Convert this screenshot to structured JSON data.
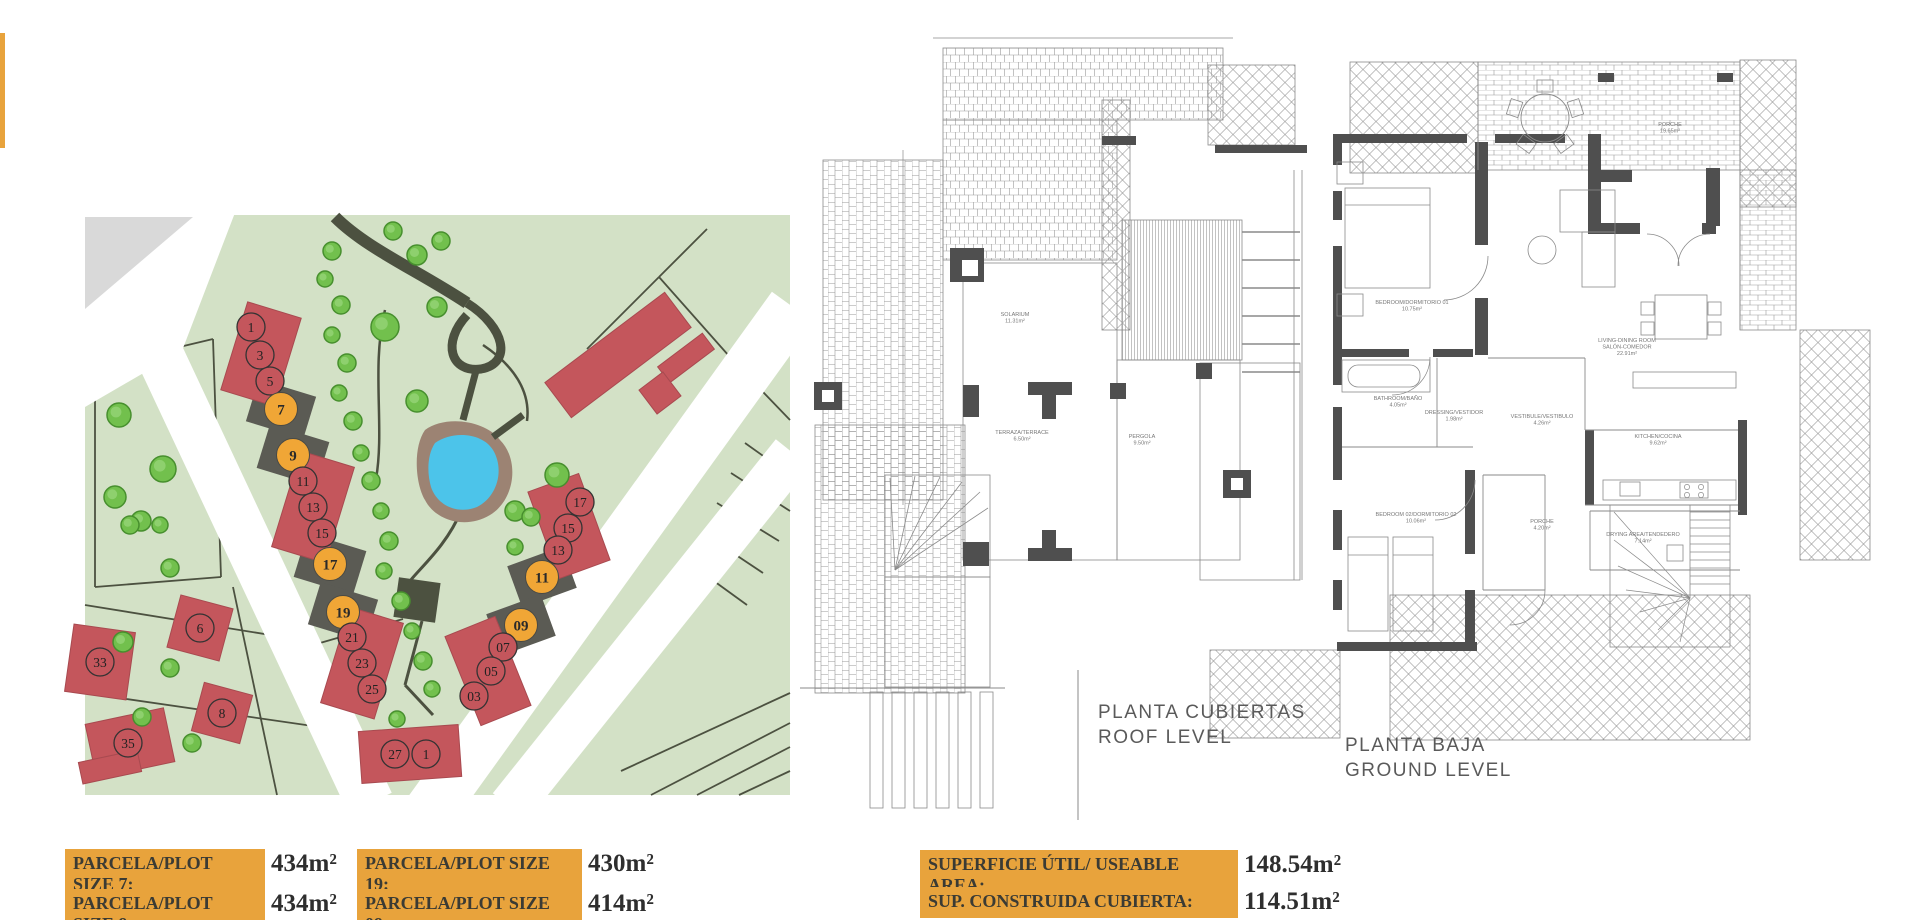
{
  "colors": {
    "accent_orange": "#E8A33C",
    "plot_red": "#C4565C",
    "plot_orange": "#F0A636",
    "map_green": "#D3E1C6",
    "pool_blue": "#4CC4EA",
    "path_olive": "#4C5140",
    "plan_line": "#8A8A8A",
    "wall_gray": "#4F4F4F"
  },
  "site_plan": {
    "markers": [
      {
        "n": "1",
        "x": 166,
        "y": 112,
        "c": "red"
      },
      {
        "n": "3",
        "x": 175,
        "y": 140,
        "c": "red"
      },
      {
        "n": "5",
        "x": 185,
        "y": 166,
        "c": "red"
      },
      {
        "n": "7",
        "x": 196,
        "y": 194,
        "c": "orange"
      },
      {
        "n": "9",
        "x": 208,
        "y": 240,
        "c": "orange"
      },
      {
        "n": "11",
        "x": 218,
        "y": 266,
        "c": "red"
      },
      {
        "n": "13",
        "x": 228,
        "y": 292,
        "c": "red"
      },
      {
        "n": "15",
        "x": 237,
        "y": 318,
        "c": "red"
      },
      {
        "n": "17",
        "x": 245,
        "y": 349,
        "c": "orange"
      },
      {
        "n": "19",
        "x": 258,
        "y": 397,
        "c": "orange"
      },
      {
        "n": "21",
        "x": 267,
        "y": 422,
        "c": "red"
      },
      {
        "n": "23",
        "x": 277,
        "y": 448,
        "c": "red"
      },
      {
        "n": "25",
        "x": 287,
        "y": 474,
        "c": "red"
      },
      {
        "n": "27",
        "x": 310,
        "y": 539,
        "c": "red"
      },
      {
        "n": "1",
        "x": 341,
        "y": 539,
        "c": "red"
      },
      {
        "n": "17",
        "x": 495,
        "y": 287,
        "c": "red"
      },
      {
        "n": "15",
        "x": 483,
        "y": 313,
        "c": "red"
      },
      {
        "n": "13",
        "x": 473,
        "y": 335,
        "c": "red"
      },
      {
        "n": "11",
        "x": 457,
        "y": 362,
        "c": "orange"
      },
      {
        "n": "09",
        "x": 436,
        "y": 410,
        "c": "orange"
      },
      {
        "n": "07",
        "x": 418,
        "y": 432,
        "c": "red"
      },
      {
        "n": "05",
        "x": 406,
        "y": 456,
        "c": "red"
      },
      {
        "n": "03",
        "x": 389,
        "y": 481,
        "c": "red"
      },
      {
        "n": "33",
        "x": 15,
        "y": 447,
        "c": "red"
      },
      {
        "n": "6",
        "x": 115,
        "y": 413,
        "c": "red"
      },
      {
        "n": "8",
        "x": 137,
        "y": 498,
        "c": "red"
      },
      {
        "n": "35",
        "x": 43,
        "y": 528,
        "c": "red"
      }
    ]
  },
  "roof_plan": {
    "title": "PLANTA CUBIERTAS",
    "subtitle": "ROOF LEVEL",
    "rooms": [
      {
        "lines": [
          "SOLARIUM",
          "11.31m²"
        ],
        "x": 215,
        "y": 296
      },
      {
        "lines": [
          "TERRAZA/TERRACE",
          "6.50m²"
        ],
        "x": 222,
        "y": 414
      },
      {
        "lines": [
          "PERGOLA",
          "9.50m²"
        ],
        "x": 342,
        "y": 418
      }
    ]
  },
  "ground_plan": {
    "title": "PLANTA BAJA",
    "subtitle": "GROUND LEVEL",
    "rooms": [
      {
        "lines": [
          "BEDROOM/DORMITORIO 01",
          "10.75m²"
        ],
        "x": 322,
        "y": 254
      },
      {
        "lines": [
          "LIVING-DINING ROOM",
          "SALÓN-COMEDOR",
          "22.91m²"
        ],
        "x": 537,
        "y": 292
      },
      {
        "lines": [
          "BATHROOM/BAÑO",
          "4.05m²"
        ],
        "x": 308,
        "y": 350
      },
      {
        "lines": [
          "DRESSING/VESTIDOR",
          "1.98m²"
        ],
        "x": 364,
        "y": 364
      },
      {
        "lines": [
          "VESTIBULE/VESTIBULO",
          "4.26m²"
        ],
        "x": 452,
        "y": 368
      },
      {
        "lines": [
          "KITCHEN/COCINA",
          "9.62m²"
        ],
        "x": 568,
        "y": 388
      },
      {
        "lines": [
          "BEDROOM 02/DORMITORIO 02",
          "10.06m²"
        ],
        "x": 326,
        "y": 466
      },
      {
        "lines": [
          "DRYING AREA/TENDEDERO",
          "7.14m²"
        ],
        "x": 553,
        "y": 486
      },
      {
        "lines": [
          "PORCHE",
          "4.20m²"
        ],
        "x": 452,
        "y": 473
      },
      {
        "lines": [
          "PORCHE",
          "19.65m²"
        ],
        "x": 580,
        "y": 76
      }
    ]
  },
  "area_labels": {
    "plots": [
      {
        "label": "PARCELA/PLOT SIZE 7:",
        "value": "434m²"
      },
      {
        "label": "PARCELA/PLOT SIZE 19:",
        "value": "430m²"
      },
      {
        "label": "PARCELA/PLOT SIZE 9:",
        "value": "434m²"
      },
      {
        "label": "PARCELA/PLOT SIZE 09:",
        "value": "414m²"
      }
    ],
    "areas": [
      {
        "label": "SUPERFICIE ÚTIL/ USEABLE AREA:",
        "value": "148.54m²"
      },
      {
        "label": "SUP. CONSTRUIDA CUBIERTA:",
        "value": "114.51m²"
      }
    ]
  }
}
